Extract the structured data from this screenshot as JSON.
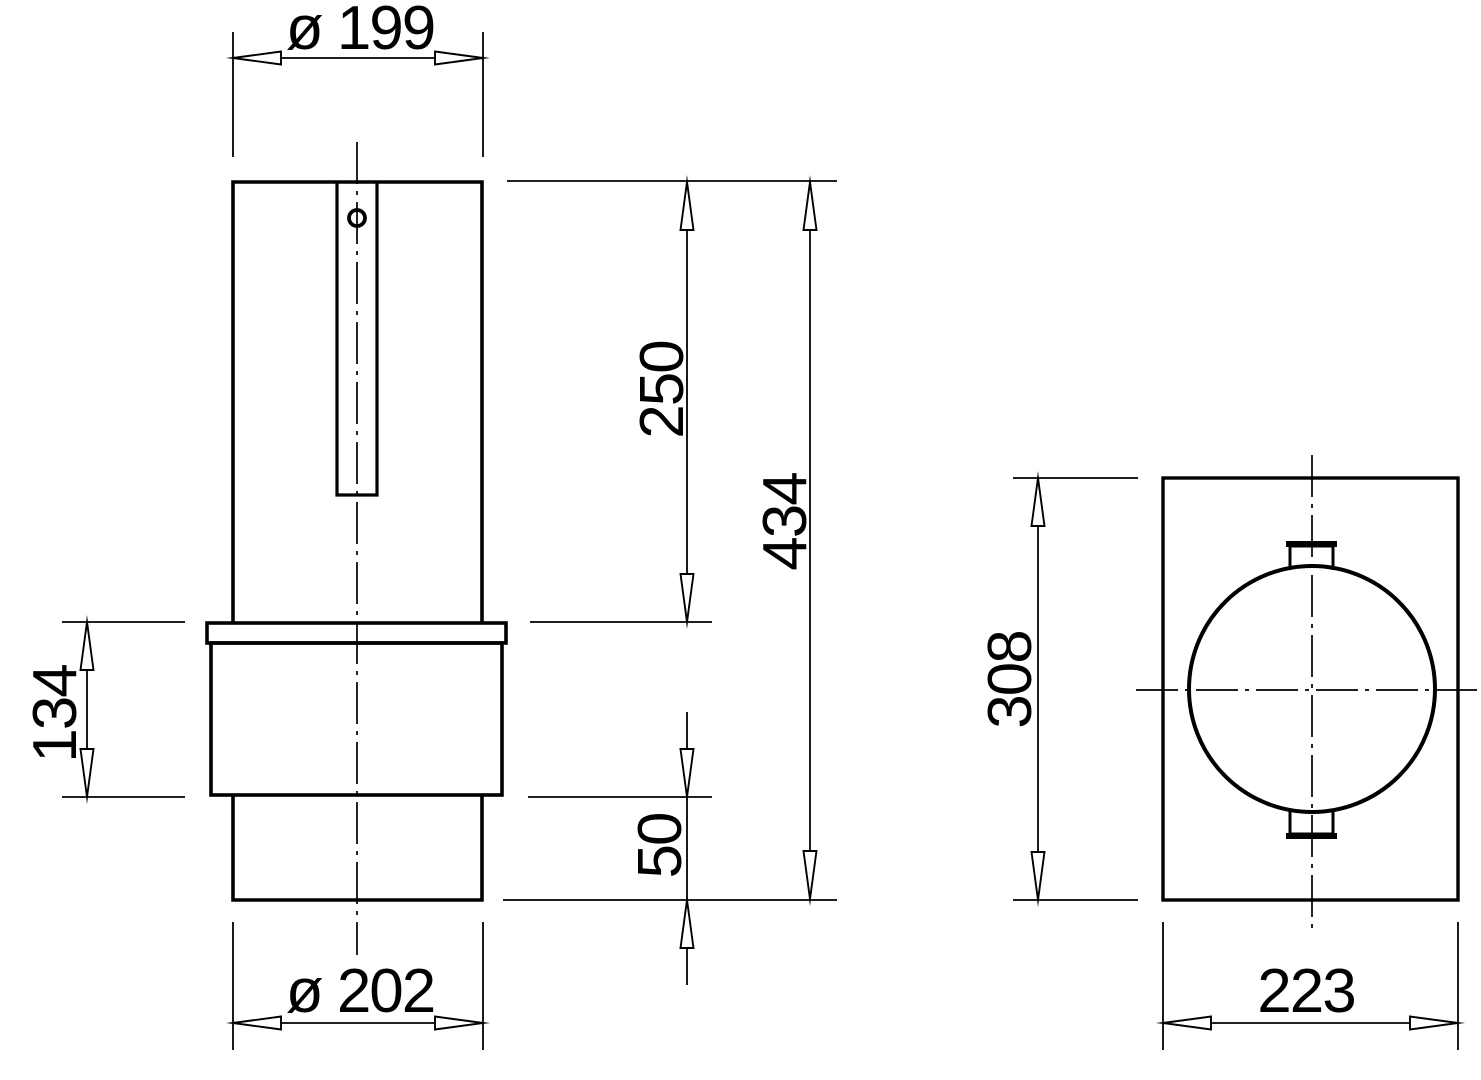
{
  "page": {
    "background_color": "#ffffff",
    "line_color": "#000000"
  },
  "front_view": {
    "dims": {
      "top_diameter": "ø 199",
      "upper_length": "250",
      "overall_length": "434",
      "collar_length": "134",
      "lower_offset": "50",
      "bottom_diameter": "ø 202"
    }
  },
  "side_view": {
    "dims": {
      "height": "308",
      "width": "223"
    }
  }
}
